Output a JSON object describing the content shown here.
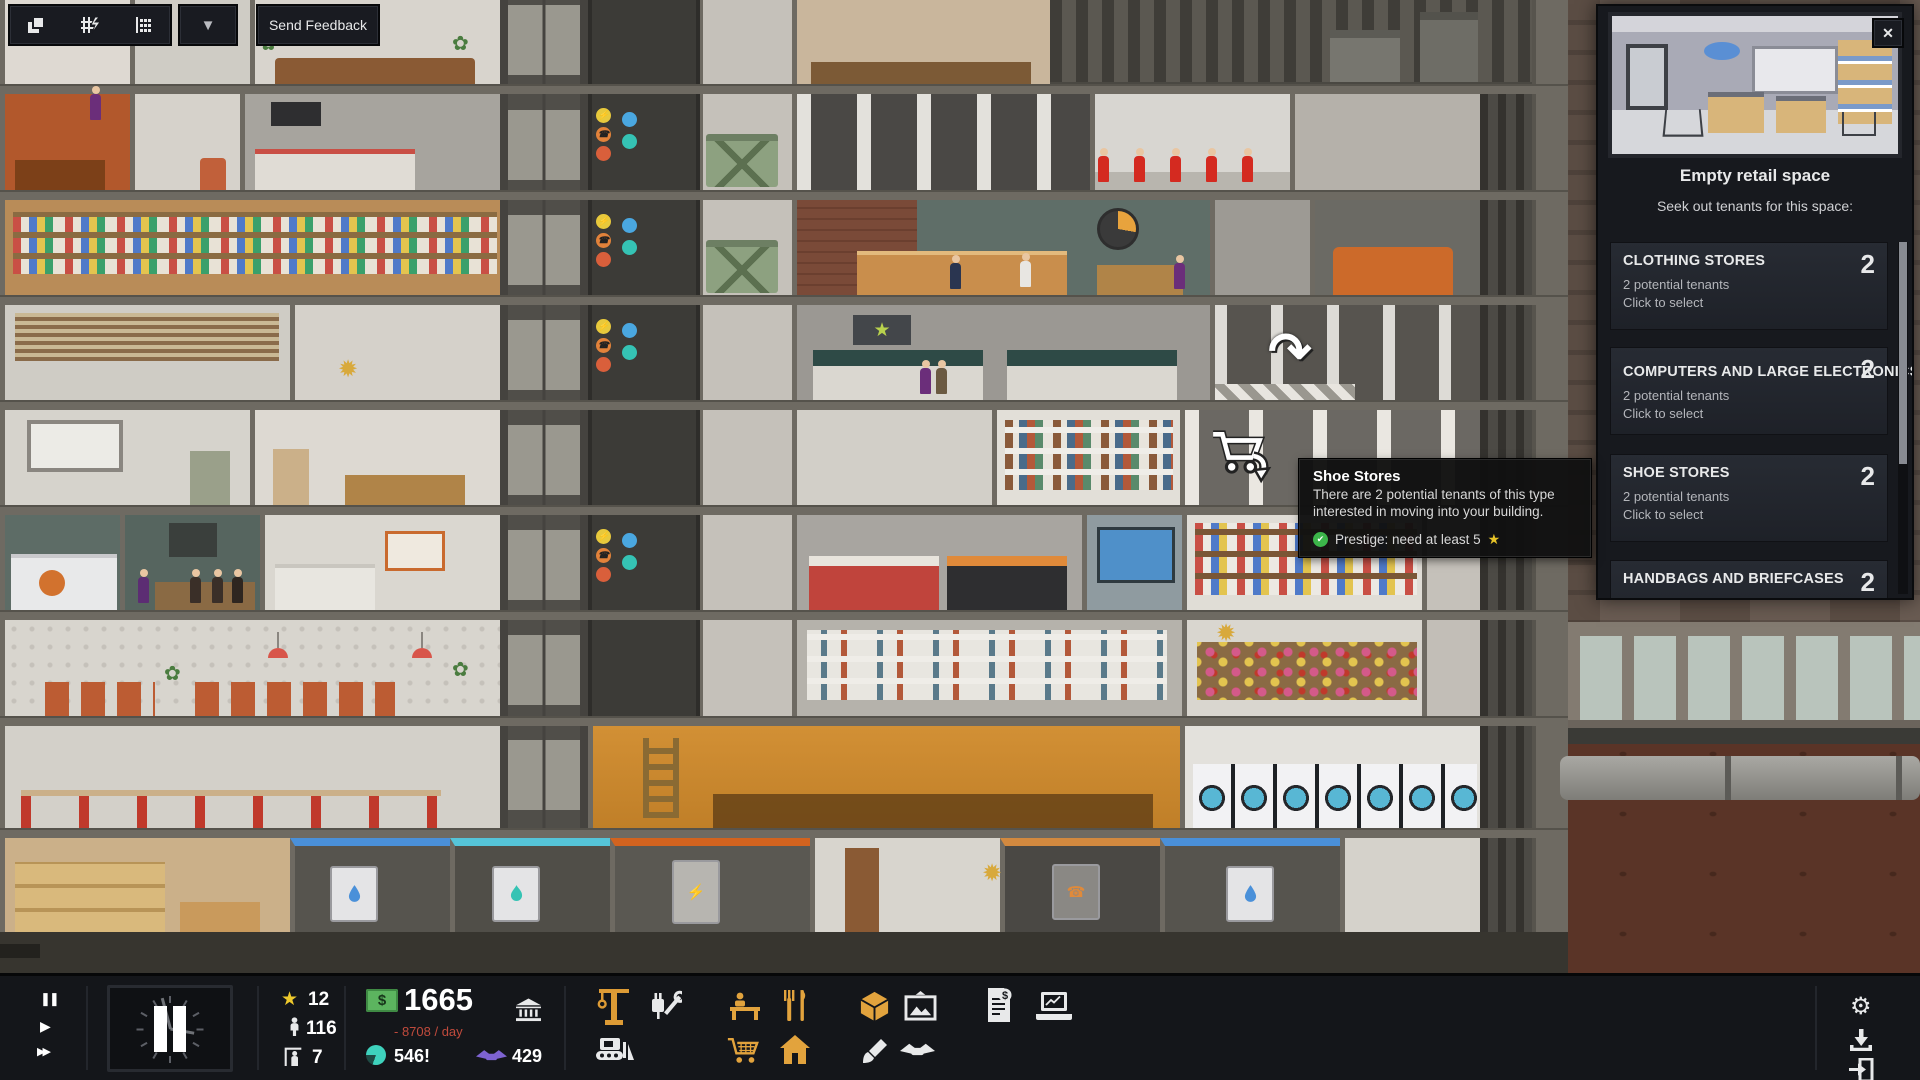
{
  "icons": {
    "pause": "❚❚",
    "play": "▶",
    "fast_forward": "▶▶",
    "collapse": "▼",
    "close": "✕",
    "rotate_cursor": "↷",
    "star": "★",
    "gear": "⚙",
    "check": "✔",
    "sun": "✹",
    "plant": "✿",
    "bolt": "⚡",
    "phone": "☎",
    "dollar": "$"
  },
  "toolbar": {
    "send_feedback": "Send Feedback"
  },
  "panel": {
    "title": "Empty retail space",
    "subtitle": "Seek out tenants for this space:",
    "tenants": [
      {
        "name": "CLOTHING STORES",
        "count": "2",
        "line1": "2 potential tenants",
        "line2": "Click to select"
      },
      {
        "name": "COMPUTERS AND LARGE ELECTRONICS",
        "count": "2",
        "line1": "2 potential tenants",
        "line2": "Click to select"
      },
      {
        "name": "SHOE STORES",
        "count": "2",
        "line1": "2 potential tenants",
        "line2": "Click to select"
      },
      {
        "name": "HANDBAGS AND BRIEFCASES",
        "count": "2",
        "line1": "2 potential tenants",
        "line2": "Click to select"
      }
    ]
  },
  "tooltip": {
    "title": "Shoe Stores",
    "body": "There are 2 potential tenants of this type interested in moving into your building.",
    "requirement": "Prestige: need at least 5",
    "requirement_star": "★"
  },
  "statusbar": {
    "prestige": "12",
    "population": "116",
    "move_ins": "7",
    "money": "1665",
    "cashflow": "- 8708 / day",
    "buzz": "546!",
    "deals": "429"
  },
  "colors": {
    "accent_orange": "#e2a33d",
    "money_green": "#5cb45f",
    "negative_red": "#c04a3c",
    "buzz_teal": "#3ed2bd",
    "deals_purple": "#7e63d2",
    "prestige_gold": "#eec92c",
    "check_green": "#3cb54a",
    "panel_bg": "#17191e",
    "bar_bg": "#14161a"
  }
}
